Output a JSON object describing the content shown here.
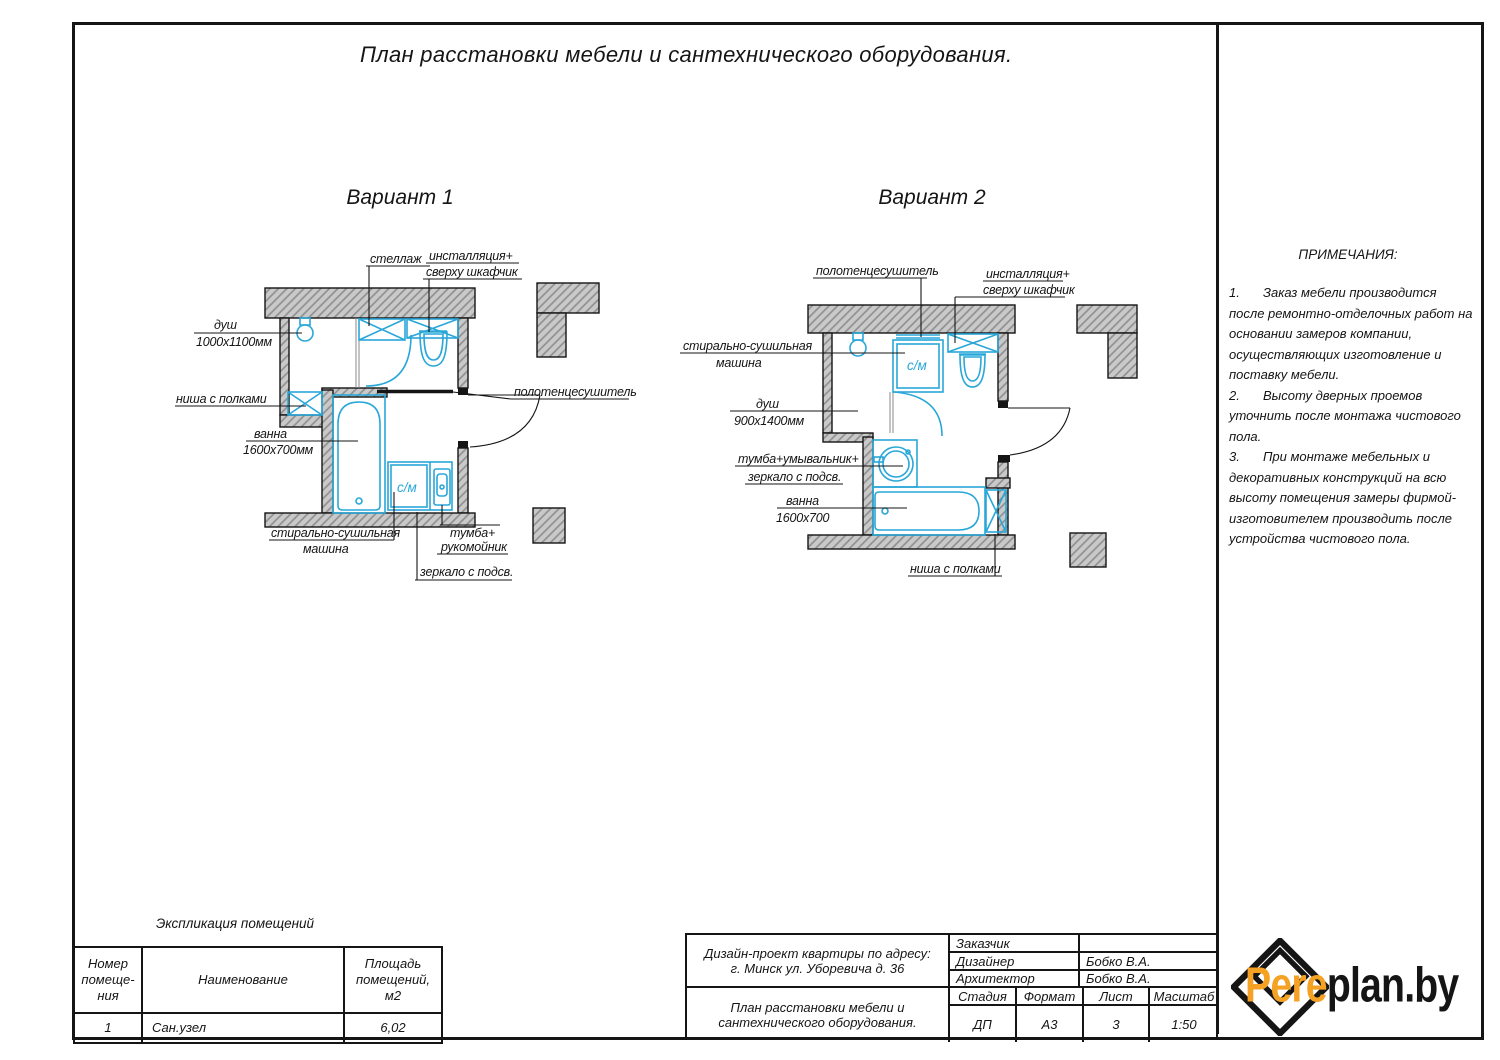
{
  "sheet": {
    "title": "План расстановки мебели и сантехнического оборудования.",
    "variant1": "Вариант 1",
    "variant2": "Вариант 2"
  },
  "plan1": {
    "wm_label": "с/м",
    "labels": {
      "shelving": "стеллаж",
      "installation1": "инсталляция+",
      "installation2": "сверху шкафчик",
      "shower1": "душ",
      "shower2": "1000х1100мм",
      "niche": "ниша с полками",
      "bath1": "ванна",
      "bath2": "1600х700мм",
      "towel": "полотенцесушитель",
      "washer1": "стирально-сушильная",
      "washer2": "машина",
      "vanity1": "тумба+",
      "vanity2": "рукомойник",
      "mirror": "зеркало с подсв."
    }
  },
  "plan2": {
    "wm_label": "с/м",
    "labels": {
      "towel": "полотенцесушитель",
      "installation1": "инсталляция+",
      "installation2": "сверху шкафчик",
      "washer1": "стирально-сушильная",
      "washer2": "машина",
      "shower1": "душ",
      "shower2": "900х1400мм",
      "vanity1": "тумба+умывальник+",
      "vanity2": "зеркало с подсв.",
      "bath1": "ванна",
      "bath2": "1600х700",
      "niche": "ниша с полками"
    }
  },
  "notes": {
    "heading": "ПРИМЕЧАНИЯ:",
    "items": [
      {
        "num": "1.",
        "text": "Заказ мебели производится после ремонтно-отделочных работ на основании замеров компании, осуществляющих изготовление и поставку мебели."
      },
      {
        "num": "2.",
        "text": "Высоту дверных проемов уточнить после монтажа чистового пола."
      },
      {
        "num": "3.",
        "text": "При монтаже мебельных и декоративных конструкций на всю высоту помещения замеры фирмой-изготовителем производить после устройства чистового пола."
      }
    ]
  },
  "explication": {
    "heading": "Экспликация помещений",
    "col1": "Номер помеще-ния",
    "col2": "Наименование",
    "col3": "Площадь помещений, м2",
    "row": {
      "num": "1",
      "name": "Сан.узел",
      "area": "6,02"
    }
  },
  "titleblock": {
    "project_line1": "Дизайн-проект квартиры по адресу:",
    "project_line2": "г. Минск ул. Уборевича д. 36",
    "doc_title": "План расстановки мебели и сантехнического оборудования.",
    "customer_label": "Заказчик",
    "customer_value": "",
    "designer_label": "Дизайнер",
    "designer_value": "Бобко В.А.",
    "architect_label": "Архитектор",
    "architect_value": "Бобко В.А.",
    "stage_label": "Стадия",
    "stage_value": "ДП",
    "format_label": "Формат",
    "format_value": "А3",
    "sheet_label": "Лист",
    "sheet_value": "3",
    "scale_label": "Масштаб",
    "scale_value": "1:50"
  },
  "logo": {
    "part1": "Pere",
    "part2": "plan.by"
  },
  "colors": {
    "fixture_blue": "#29a7d8",
    "logo_orange": "#f5a124",
    "line_black": "#151515"
  }
}
